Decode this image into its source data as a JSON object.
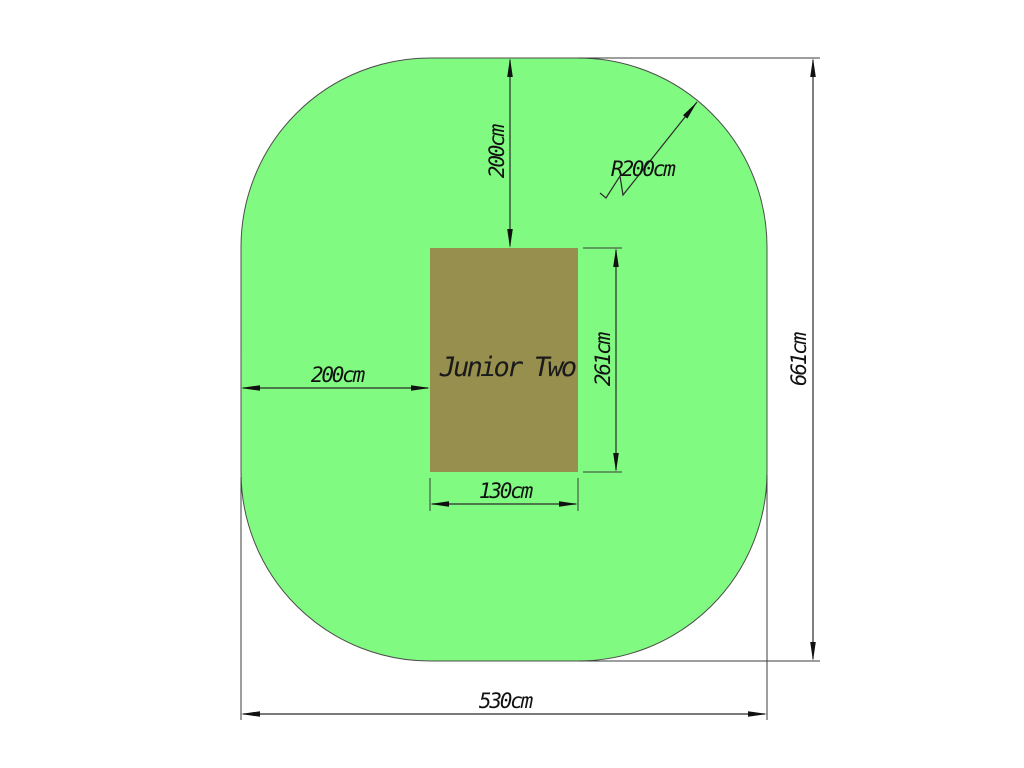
{
  "diagram": {
    "equipment_label": "Junior Two",
    "dimensions": {
      "clearance_top": "200cm",
      "clearance_left": "200cm",
      "corner_radius": "R200cm",
      "overall_height": "661cm",
      "overall_width": "530cm",
      "equipment_width": "130cm",
      "equipment_height": "261cm"
    },
    "colors": {
      "safety_zone_fill": "#80FA80",
      "safety_zone_outline": "#4D4D4D",
      "equipment_fill": "#968F4D",
      "dimension_line": "#2B2B2B",
      "text": "#111111",
      "background": "#FFFFFF"
    }
  }
}
